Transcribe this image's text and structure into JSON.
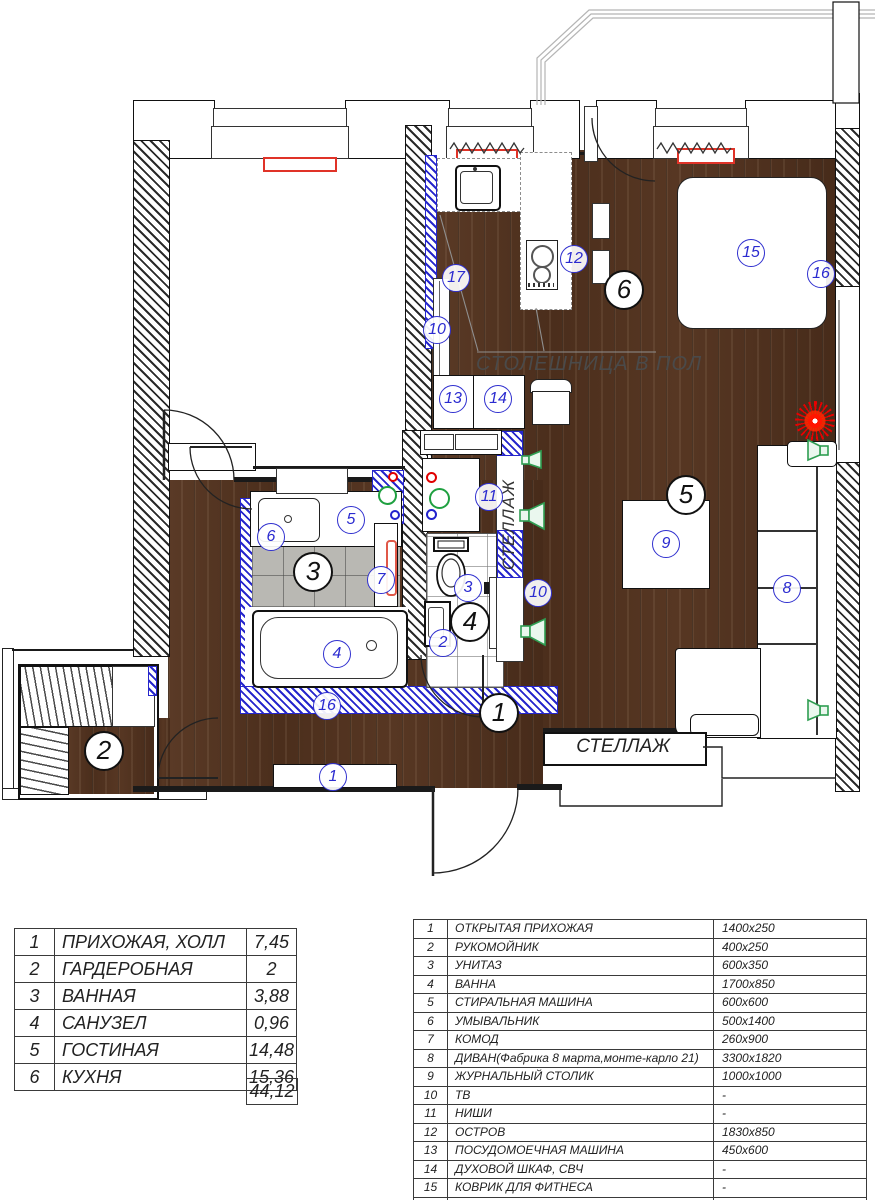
{
  "annotations": {
    "countertop": "СТОЛЕШНИЦА В ПОЛ",
    "shelf_vertical": "СТЕЛЛАЖ",
    "shelf_horizontal": "СТЕЛЛАЖ"
  },
  "room_markers": [
    {
      "label": "1",
      "x": 497,
      "y": 711
    },
    {
      "label": "2",
      "x": 102,
      "y": 749
    },
    {
      "label": "3",
      "x": 311,
      "y": 570
    },
    {
      "label": "4",
      "x": 468,
      "y": 620
    },
    {
      "label": "5",
      "x": 684,
      "y": 493
    },
    {
      "label": "6",
      "x": 622,
      "y": 288
    }
  ],
  "item_markers": [
    {
      "label": "1",
      "x": 332,
      "y": 776
    },
    {
      "label": "2",
      "x": 442,
      "y": 642
    },
    {
      "label": "3",
      "x": 467,
      "y": 587
    },
    {
      "label": "4",
      "x": 336,
      "y": 653
    },
    {
      "label": "5",
      "x": 350,
      "y": 519
    },
    {
      "label": "6",
      "x": 270,
      "y": 536
    },
    {
      "label": "7",
      "x": 380,
      "y": 579
    },
    {
      "label": "8",
      "x": 786,
      "y": 588
    },
    {
      "label": "9",
      "x": 665,
      "y": 543
    },
    {
      "label": "10",
      "x": 436,
      "y": 329
    },
    {
      "label": "10",
      "x": 537,
      "y": 592
    },
    {
      "label": "11",
      "x": 488,
      "y": 496
    },
    {
      "label": "12",
      "x": 573,
      "y": 258
    },
    {
      "label": "13",
      "x": 452,
      "y": 398
    },
    {
      "label": "14",
      "x": 497,
      "y": 398
    },
    {
      "label": "15",
      "x": 750,
      "y": 252
    },
    {
      "label": "16",
      "x": 326,
      "y": 705
    },
    {
      "label": "16",
      "x": 820,
      "y": 273
    },
    {
      "label": "17",
      "x": 455,
      "y": 277
    }
  ],
  "rooms_table": {
    "rows": [
      [
        "1",
        "ПРИХОЖАЯ, ХОЛЛ",
        "7,45"
      ],
      [
        "2",
        "ГАРДЕРОБНАЯ",
        "2"
      ],
      [
        "3",
        "ВАННАЯ",
        "3,88"
      ],
      [
        "4",
        "САНУЗЕЛ",
        "0,96"
      ],
      [
        "5",
        "ГОСТИНАЯ",
        "14,48"
      ],
      [
        "6",
        "КУХНЯ",
        "15,36"
      ]
    ],
    "total": "44,12"
  },
  "items_table": {
    "rows": [
      [
        "1",
        "ОТКРЫТАЯ ПРИХОЖАЯ",
        "1400x250"
      ],
      [
        "2",
        "РУКОМОЙНИК",
        "400x250"
      ],
      [
        "3",
        "УНИТАЗ",
        "600x350"
      ],
      [
        "4",
        "ВАННА",
        "1700x850"
      ],
      [
        "5",
        "СТИРАЛЬНАЯ МАШИНА",
        "600x600"
      ],
      [
        "6",
        "УМЫВАЛЬНИК",
        "500x1400"
      ],
      [
        "7",
        "КОМОД",
        "260x900"
      ],
      [
        "8",
        "ДИВАН(Фабрика 8 марта,монте-карло 21)",
        "3300x1820"
      ],
      [
        "9",
        "ЖУРНАЛЬНЫЙ СТОЛИК",
        "1000x1000"
      ],
      [
        "10",
        "ТВ",
        "-"
      ],
      [
        "11",
        "НИШИ",
        "-"
      ],
      [
        "12",
        "ОСТРОВ",
        "1830x850"
      ],
      [
        "13",
        "ПОСУДОМОЕЧНАЯ МАШИНА",
        "450x600"
      ],
      [
        "14",
        "ДУХОВОЙ ШКАФ, СВЧ",
        "-"
      ],
      [
        "15",
        "КОВРИК ДЛЯ ФИТНЕСА",
        "-"
      ],
      [
        "16",
        "ЗЕРКАЛО",
        "-"
      ],
      [
        "17",
        "КОНДИЦИОНЕР",
        "-"
      ]
    ]
  },
  "colors": {
    "wood": "#4e3120",
    "partition_blue": "#2626cc",
    "marker_blue": "#3030cf",
    "radiator_red": "#e03328",
    "speaker_green": "#2f9e52",
    "tile_gray": "#b9b8b3"
  }
}
